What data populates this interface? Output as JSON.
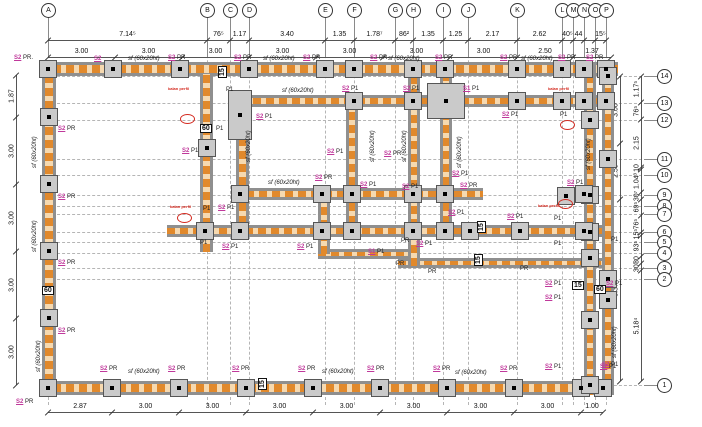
{
  "meta": {
    "drawing_kind": "structural formwork floor plan"
  },
  "colors": {
    "beam_gray": "#8f8f8f",
    "beam_orange": "#e1892c",
    "beam_orange_light": "#f6d9b0",
    "column_fill": "#cacaca",
    "label_pink": "#c0399b",
    "mark_red": "#d42a20",
    "dim_line": "#555555",
    "grid_line": "#b5b5b5"
  },
  "grid": {
    "columns": [
      {
        "label": "A",
        "x": 48
      },
      {
        "label": "B",
        "x": 207
      },
      {
        "label": "C",
        "x": 230
      },
      {
        "label": "D",
        "x": 249
      },
      {
        "label": "E",
        "x": 325
      },
      {
        "label": "F",
        "x": 354
      },
      {
        "label": "G",
        "x": 395
      },
      {
        "label": "H",
        "x": 413
      },
      {
        "label": "I",
        "x": 443
      },
      {
        "label": "J",
        "x": 468
      },
      {
        "label": "K",
        "x": 517
      },
      {
        "label": "L",
        "x": 562
      },
      {
        "label": "M",
        "x": 573
      },
      {
        "label": "N",
        "x": 584
      },
      {
        "label": "O",
        "x": 595
      },
      {
        "label": "P",
        "x": 606
      }
    ],
    "rows": [
      {
        "label": "14",
        "y": 76
      },
      {
        "label": "13",
        "y": 103
      },
      {
        "label": "12",
        "y": 120
      },
      {
        "label": "11",
        "y": 159
      },
      {
        "label": "10",
        "y": 175
      },
      {
        "label": "9",
        "y": 195
      },
      {
        "label": "8",
        "y": 206
      },
      {
        "label": "7",
        "y": 214
      },
      {
        "label": "6",
        "y": 232
      },
      {
        "label": "5",
        "y": 242
      },
      {
        "label": "4",
        "y": 253
      },
      {
        "label": "3",
        "y": 268
      },
      {
        "label": "2",
        "y": 279
      },
      {
        "label": "1",
        "y": 385
      }
    ]
  },
  "dims": {
    "top1": {
      "orient": "h",
      "pos": 40,
      "ticks": [
        48,
        207,
        230,
        249,
        325,
        354,
        395,
        413,
        443,
        468,
        517,
        562,
        573,
        584,
        595,
        606
      ],
      "values": [
        "7.14⁵",
        "76⁵",
        "1.17",
        "3.40",
        "1.35",
        "1.78⁷",
        "86²",
        "1.35",
        "1.25",
        "2.17",
        "2.62",
        "40⁵",
        "44",
        "",
        "15⁵"
      ]
    },
    "top2": {
      "orient": "h",
      "pos": 57,
      "ticks": [
        48,
        115,
        182,
        249,
        316,
        383,
        450,
        517,
        573,
        611
      ],
      "values": [
        "3.00",
        "3.00",
        "3.00",
        "3.00",
        "3.00",
        "3.00",
        "3.00",
        "2.50",
        "1.37"
      ]
    },
    "bottom": {
      "orient": "h",
      "pos": 412,
      "ticks": [
        48,
        112,
        179,
        246,
        313,
        380,
        447,
        514,
        581,
        603
      ],
      "values": [
        "2.87",
        "3.00",
        "3.00",
        "3.00",
        "3.00",
        "3.00",
        "3.00",
        "3.00",
        "1.00"
      ]
    },
    "left": {
      "orient": "v",
      "pos": 16,
      "ticks": [
        75,
        117,
        184,
        251,
        318,
        385
      ],
      "values": [
        "1.87",
        "3.00",
        "3.00",
        "3.00",
        "3.00"
      ]
    },
    "right_a": {
      "orient": "v",
      "pos": 620,
      "ticks": [
        76,
        143,
        199,
        381
      ],
      "values": [
        "3.00",
        "2.50",
        "8.37"
      ]
    },
    "right_b": {
      "orient": "v",
      "pos": 641,
      "ticks": [
        76,
        102,
        119,
        167,
        169,
        192,
        199,
        215,
        232,
        235,
        256,
        263,
        270,
        381
      ],
      "values": [
        "1.17⁵",
        "76⁵",
        "2.15",
        "10",
        "1.04³",
        "30⁷",
        "69⁵",
        "76⁵",
        "15⁵",
        "93⁵",
        "30",
        "30¹",
        "5.18⁴"
      ]
    }
  },
  "beams": {
    "horizontal": [
      {
        "x": 40,
        "y": 62,
        "w": 578,
        "h": 14
      },
      {
        "x": 240,
        "y": 95,
        "w": 374,
        "h": 12
      },
      {
        "x": 233,
        "y": 188,
        "w": 250,
        "h": 12
      },
      {
        "x": 167,
        "y": 225,
        "w": 447,
        "h": 12
      },
      {
        "x": 318,
        "y": 249,
        "w": 92,
        "h": 10
      },
      {
        "x": 398,
        "y": 258,
        "w": 208,
        "h": 10
      },
      {
        "x": 40,
        "y": 381,
        "w": 572,
        "h": 14
      }
    ],
    "vertical": [
      {
        "x": 42,
        "y": 62,
        "w": 14,
        "h": 333
      },
      {
        "x": 200,
        "y": 74,
        "w": 13,
        "h": 178
      },
      {
        "x": 236,
        "y": 95,
        "w": 13,
        "h": 142
      },
      {
        "x": 318,
        "y": 188,
        "w": 12,
        "h": 66
      },
      {
        "x": 346,
        "y": 95,
        "w": 12,
        "h": 142
      },
      {
        "x": 408,
        "y": 74,
        "w": 12,
        "h": 192
      },
      {
        "x": 440,
        "y": 74,
        "w": 12,
        "h": 163
      },
      {
        "x": 584,
        "y": 62,
        "w": 12,
        "h": 333
      },
      {
        "x": 602,
        "y": 62,
        "w": 12,
        "h": 333
      }
    ]
  },
  "concrete_columns": {
    "small": [
      [
        48,
        69
      ],
      [
        113,
        69
      ],
      [
        180,
        69
      ],
      [
        249,
        69
      ],
      [
        325,
        69
      ],
      [
        354,
        69
      ],
      [
        413,
        69
      ],
      [
        445,
        69
      ],
      [
        517,
        69
      ],
      [
        562,
        69
      ],
      [
        584,
        69
      ],
      [
        606,
        69
      ],
      [
        49,
        117
      ],
      [
        49,
        184
      ],
      [
        49,
        251
      ],
      [
        49,
        318
      ],
      [
        48,
        388
      ],
      [
        112,
        388
      ],
      [
        179,
        388
      ],
      [
        246,
        388
      ],
      [
        313,
        388
      ],
      [
        380,
        388
      ],
      [
        447,
        388
      ],
      [
        514,
        388
      ],
      [
        581,
        388
      ],
      [
        603,
        388
      ],
      [
        590,
        120
      ],
      [
        590,
        195
      ],
      [
        590,
        232
      ],
      [
        590,
        320
      ],
      [
        590,
        385
      ],
      [
        608,
        76
      ],
      [
        608,
        159
      ],
      [
        608,
        279
      ],
      [
        354,
        101
      ],
      [
        413,
        101
      ],
      [
        517,
        101
      ],
      [
        562,
        101
      ],
      [
        584,
        101
      ],
      [
        606,
        101
      ],
      [
        240,
        194
      ],
      [
        322,
        194
      ],
      [
        352,
        194
      ],
      [
        413,
        194
      ],
      [
        445,
        194
      ],
      [
        584,
        194
      ],
      [
        205,
        231
      ],
      [
        240,
        231
      ],
      [
        322,
        231
      ],
      [
        352,
        231
      ],
      [
        413,
        231
      ],
      [
        445,
        231
      ],
      [
        470,
        231
      ],
      [
        520,
        231
      ],
      [
        584,
        231
      ],
      [
        207,
        148
      ],
      [
        566,
        196
      ],
      [
        590,
        258
      ],
      [
        608,
        300
      ]
    ],
    "large": [
      {
        "x": 228,
        "y": 90,
        "w": 24,
        "h": 50
      },
      {
        "x": 427,
        "y": 83,
        "w": 38,
        "h": 36
      }
    ]
  },
  "annotations": [
    {
      "t": "S2 PR.",
      "x": 14,
      "y": 55,
      "c": "combo"
    },
    {
      "t": "S2",
      "x": 94,
      "y": 56,
      "c": "pink"
    },
    {
      "t": "sf (60x20ht)",
      "x": 128,
      "y": 56,
      "c": "sf"
    },
    {
      "t": "S2 PR",
      "x": 168,
      "y": 55,
      "c": "combo"
    },
    {
      "t": "S2 PR",
      "x": 234,
      "y": 55,
      "c": "combo"
    },
    {
      "t": "sf (60x20ht)",
      "x": 263,
      "y": 56,
      "c": "sf"
    },
    {
      "t": "S2 PR",
      "x": 303,
      "y": 55,
      "c": "combo"
    },
    {
      "t": "S2 PR",
      "x": 370,
      "y": 55,
      "c": "combo"
    },
    {
      "t": "sf (60x20ht)",
      "x": 388,
      "y": 56,
      "c": "sf"
    },
    {
      "t": "S2 PR",
      "x": 435,
      "y": 55,
      "c": "combo"
    },
    {
      "t": "S2 PR",
      "x": 500,
      "y": 55,
      "c": "combo"
    },
    {
      "t": "sf (60x20ht)",
      "x": 521,
      "y": 56,
      "c": "sf"
    },
    {
      "t": "S2 PR",
      "x": 558,
      "y": 55,
      "c": "combo"
    },
    {
      "t": "S2 PR",
      "x": 586,
      "y": 55,
      "c": "combo"
    },
    {
      "t": "15",
      "x": 218,
      "y": 78,
      "c": "box",
      "r": -90
    },
    {
      "t": "P1",
      "x": 226,
      "y": 87,
      "c": "dark"
    },
    {
      "t": "sf (60x20ht)",
      "x": 282,
      "y": 88,
      "c": "sf"
    },
    {
      "t": "S2 P1",
      "x": 342,
      "y": 86,
      "c": "combo"
    },
    {
      "t": "S2 P1",
      "x": 403,
      "y": 86,
      "c": "combo"
    },
    {
      "t": "S1 P1",
      "x": 463,
      "y": 86,
      "c": "combo"
    },
    {
      "t": "kalan perfil",
      "x": 548,
      "y": 87,
      "c": "red"
    },
    {
      "t": "kalan perfil",
      "x": 168,
      "y": 87,
      "c": "red"
    },
    {
      "t": "S2 P1",
      "x": 502,
      "y": 112,
      "c": "combo"
    },
    {
      "t": "P1",
      "x": 560,
      "y": 112,
      "c": "dark"
    },
    {
      "t": "60",
      "x": 200,
      "y": 124,
      "c": "box"
    },
    {
      "t": "P1",
      "x": 216,
      "y": 126,
      "c": "dark"
    },
    {
      "t": "S2 P1",
      "x": 256,
      "y": 114,
      "c": "combo"
    },
    {
      "t": "S2 P1",
      "x": 182,
      "y": 148,
      "c": "combo"
    },
    {
      "t": "sf (60x20ht)",
      "x": 246,
      "y": 162,
      "c": "sf",
      "r": -90
    },
    {
      "t": "S2 P1",
      "x": 327,
      "y": 149,
      "c": "combo"
    },
    {
      "t": "S2 PR",
      "x": 384,
      "y": 151,
      "c": "combo"
    },
    {
      "t": "S2 P1",
      "x": 452,
      "y": 171,
      "c": "combo"
    },
    {
      "t": "S2 PR",
      "x": 315,
      "y": 175,
      "c": "combo"
    },
    {
      "t": "S2 P1",
      "x": 360,
      "y": 182,
      "c": "combo"
    },
    {
      "t": "S2 P1",
      "x": 402,
      "y": 184,
      "c": "combo"
    },
    {
      "t": "S2 PR",
      "x": 460,
      "y": 183,
      "c": "combo"
    },
    {
      "t": "S2 P1",
      "x": 567,
      "y": 180,
      "c": "combo"
    },
    {
      "t": "sf (60x20ht)",
      "x": 32,
      "y": 168,
      "c": "sf",
      "r": -90
    },
    {
      "t": "sf (60x20ht)",
      "x": 32,
      "y": 252,
      "c": "sf",
      "r": -90
    },
    {
      "t": "sf (60x20ht)",
      "x": 36,
      "y": 372,
      "c": "sf",
      "r": -90
    },
    {
      "t": "sf (60x20ht)",
      "x": 370,
      "y": 162,
      "c": "sf",
      "r": -90
    },
    {
      "t": "sf (60x20ht)",
      "x": 402,
      "y": 162,
      "c": "sf",
      "r": -90
    },
    {
      "t": "sf (60x20ht)",
      "x": 457,
      "y": 168,
      "c": "sf",
      "r": -90
    },
    {
      "t": "sf (60x20ht)",
      "x": 586,
      "y": 170,
      "c": "sf",
      "r": -90
    },
    {
      "t": "sf (60x20ht)",
      "x": 612,
      "y": 358,
      "c": "sf",
      "r": -90
    },
    {
      "t": "sf (60x20ht)",
      "x": 268,
      "y": 180,
      "c": "sf"
    },
    {
      "t": "kalan perfil",
      "x": 170,
      "y": 205,
      "c": "red"
    },
    {
      "t": "P1",
      "x": 203,
      "y": 206,
      "c": "dark"
    },
    {
      "t": "S2 P1",
      "x": 218,
      "y": 205,
      "c": "combo"
    },
    {
      "t": "P1",
      "x": 200,
      "y": 240,
      "c": "dark"
    },
    {
      "t": "S2 P1",
      "x": 222,
      "y": 244,
      "c": "combo"
    },
    {
      "t": "S2 P1",
      "x": 297,
      "y": 244,
      "c": "combo"
    },
    {
      "t": "S1 P1",
      "x": 368,
      "y": 249,
      "c": "combo"
    },
    {
      "t": "S2 P1",
      "x": 448,
      "y": 210,
      "c": "combo"
    },
    {
      "t": "S2 P1",
      "x": 507,
      "y": 214,
      "c": "combo"
    },
    {
      "t": "P1",
      "x": 554,
      "y": 216,
      "c": "dark"
    },
    {
      "t": "kalan perfil",
      "x": 538,
      "y": 204,
      "c": "red"
    },
    {
      "t": "15",
      "x": 477,
      "y": 233,
      "c": "box",
      "r": -90
    },
    {
      "t": "P1",
      "x": 554,
      "y": 241,
      "c": "dark"
    },
    {
      "t": "PR",
      "x": 401,
      "y": 238,
      "c": "dark"
    },
    {
      "t": "S2 P1",
      "x": 416,
      "y": 241,
      "c": "combo"
    },
    {
      "t": "15",
      "x": 474,
      "y": 266,
      "c": "box",
      "r": -90
    },
    {
      "t": "PR",
      "x": 396,
      "y": 261,
      "c": "dark"
    },
    {
      "t": "PR",
      "x": 428,
      "y": 269,
      "c": "dark"
    },
    {
      "t": "PR",
      "x": 520,
      "y": 266,
      "c": "dark"
    },
    {
      "t": "P1",
      "x": 611,
      "y": 237,
      "c": "dark"
    },
    {
      "t": "S2 P1",
      "x": 606,
      "y": 281,
      "c": "combo"
    },
    {
      "t": "15",
      "x": 572,
      "y": 281,
      "c": "box"
    },
    {
      "t": "60",
      "x": 594,
      "y": 285,
      "c": "box"
    },
    {
      "t": "S2 P1",
      "x": 545,
      "y": 281,
      "c": "combo"
    },
    {
      "t": "S2 P1",
      "x": 545,
      "y": 295,
      "c": "combo"
    },
    {
      "t": "S2 P1",
      "x": 602,
      "y": 362,
      "c": "combo"
    },
    {
      "t": "S2 PR",
      "x": 58,
      "y": 126,
      "c": "combo"
    },
    {
      "t": "S2 PR",
      "x": 58,
      "y": 194,
      "c": "combo"
    },
    {
      "t": "S2 PR",
      "x": 58,
      "y": 260,
      "c": "combo"
    },
    {
      "t": "S2 PR",
      "x": 58,
      "y": 328,
      "c": "combo"
    },
    {
      "t": "60",
      "x": 42,
      "y": 286,
      "c": "box"
    },
    {
      "t": "S2 PR",
      "x": 16,
      "y": 399,
      "c": "combo"
    },
    {
      "t": "S2 PR",
      "x": 100,
      "y": 366,
      "c": "combo"
    },
    {
      "t": "sf (60x20ht)",
      "x": 128,
      "y": 369,
      "c": "sf"
    },
    {
      "t": "S2 PR",
      "x": 168,
      "y": 366,
      "c": "combo"
    },
    {
      "t": "S2 PR",
      "x": 232,
      "y": 366,
      "c": "combo"
    },
    {
      "t": "15",
      "x": 258,
      "y": 390,
      "c": "box",
      "r": -90
    },
    {
      "t": "S2 PR",
      "x": 298,
      "y": 366,
      "c": "combo"
    },
    {
      "t": "sf (60x20ht)",
      "x": 322,
      "y": 369,
      "c": "sf"
    },
    {
      "t": "S2 PR",
      "x": 367,
      "y": 366,
      "c": "combo"
    },
    {
      "t": "S2 PR",
      "x": 433,
      "y": 366,
      "c": "combo"
    },
    {
      "t": "sf (60x20ht)",
      "x": 455,
      "y": 370,
      "c": "sf"
    },
    {
      "t": "S2 PR",
      "x": 500,
      "y": 366,
      "c": "combo"
    },
    {
      "t": "S2 P1",
      "x": 545,
      "y": 364,
      "c": "combo"
    },
    {
      "t": "S2 P1",
      "x": 600,
      "y": 364,
      "c": "combo"
    }
  ],
  "red_marks": [
    [
      180,
      114
    ],
    [
      177,
      213
    ],
    [
      560,
      120
    ],
    [
      558,
      199
    ]
  ]
}
